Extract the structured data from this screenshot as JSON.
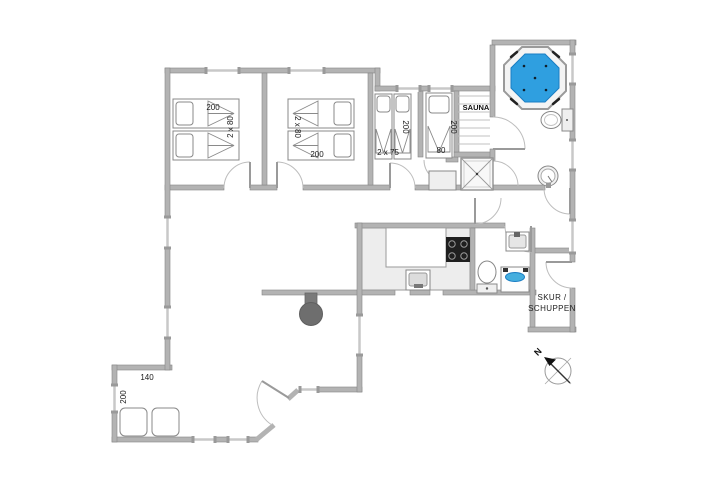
{
  "plan": {
    "bedroom1": {
      "bed_length": "200",
      "bed_width": "2 x 80"
    },
    "bedroom2": {
      "bed_length": "200",
      "bed_width": "2 x 80"
    },
    "bedroom3": {
      "bed_length": "200",
      "bed_width": "2 x 75"
    },
    "bedroom4": {
      "bed_length": "200",
      "bed_width": "80"
    },
    "sauna_label": "SAUNA",
    "shed_label_line1": "SKUR /",
    "shed_label_line2": "SCHUPPEN",
    "alcove_width": "140",
    "alcove_depth": "200",
    "compass_north": "N"
  },
  "colors": {
    "wall": "#b3b3b3",
    "wall_edge": "#858585",
    "hot_tub_water": "#2f9fe0",
    "hot_tub_rim": "#f4f4f4",
    "counter": "#ededed",
    "cooktop": "#1f1f1f",
    "wood_stove": "#6e6e6e",
    "washbasin_blue": "#45aede",
    "text": "#1a1a1a",
    "background": "#ffffff"
  },
  "fixtures": [
    "hot-tub",
    "toilet",
    "round-sink",
    "washbasin",
    "shower",
    "sauna-benches",
    "cabinet",
    "kitchen-counter",
    "cooktop",
    "kitchen-sink",
    "washing-machine",
    "wood-stove",
    "beds",
    "alcove-bed",
    "compass"
  ]
}
